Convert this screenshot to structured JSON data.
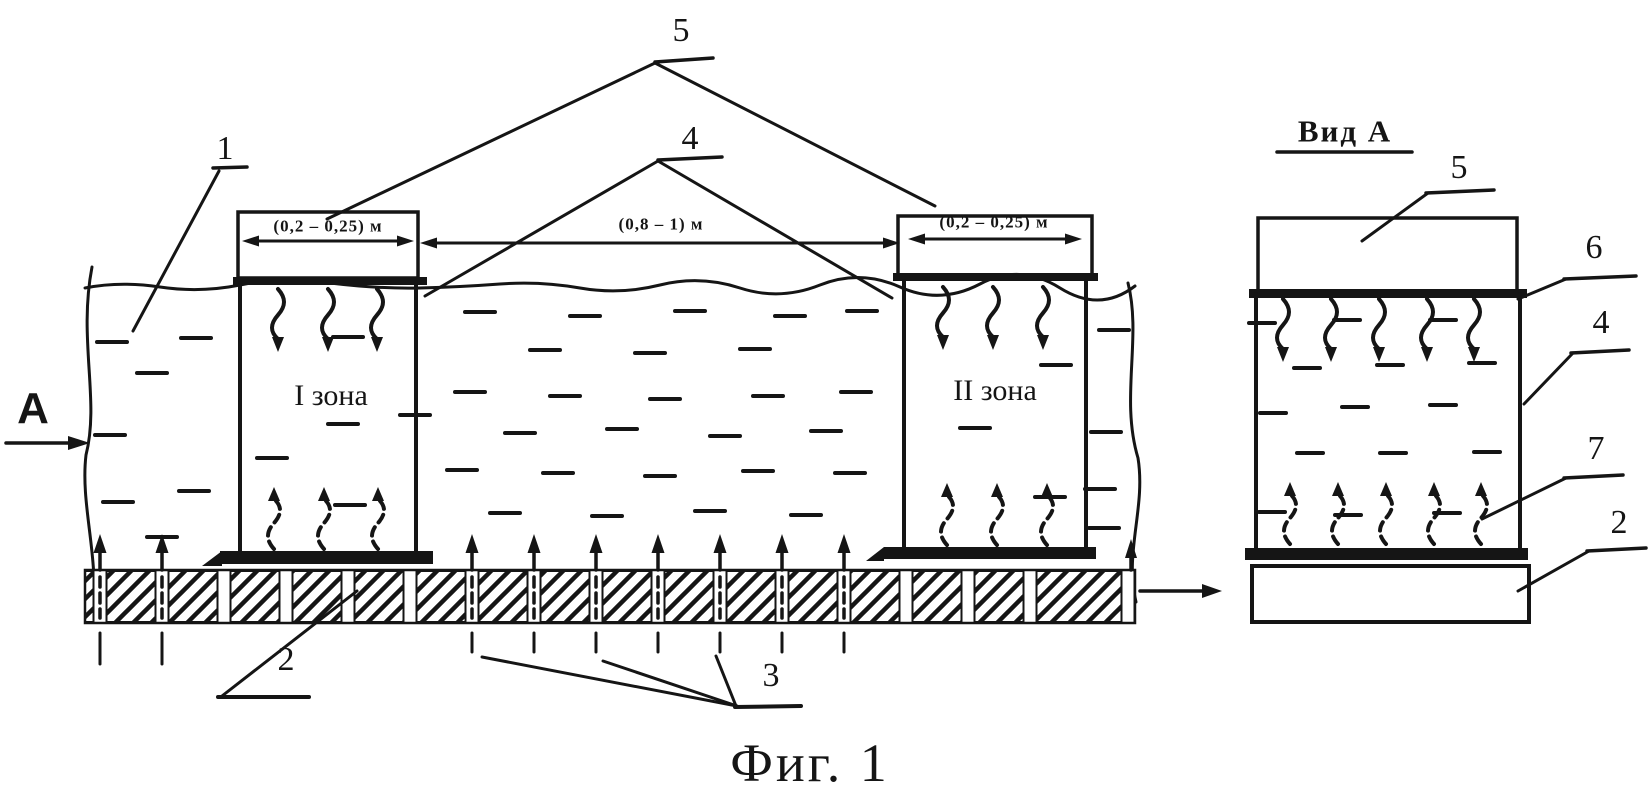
{
  "page": {
    "background": "#ffffff",
    "ink": "#151515",
    "caption": "Фиг. 1"
  },
  "main_view": {
    "section_label": "А",
    "zone1_label": "I зона",
    "zone2_label": "II зона",
    "dim_zone1": "(0,2 – 0,25) м",
    "dim_gap": "(0,8 – 1) м",
    "dim_zone2": "(0,2 – 0,25) м",
    "refs": {
      "r1": "1",
      "r2": "2",
      "r3": "3",
      "r4": "4",
      "r5": "5"
    }
  },
  "side_view": {
    "title": "Вид А",
    "refs": {
      "r2": "2",
      "r4": "4",
      "r5": "5",
      "r6": "6",
      "r7": "7"
    }
  }
}
